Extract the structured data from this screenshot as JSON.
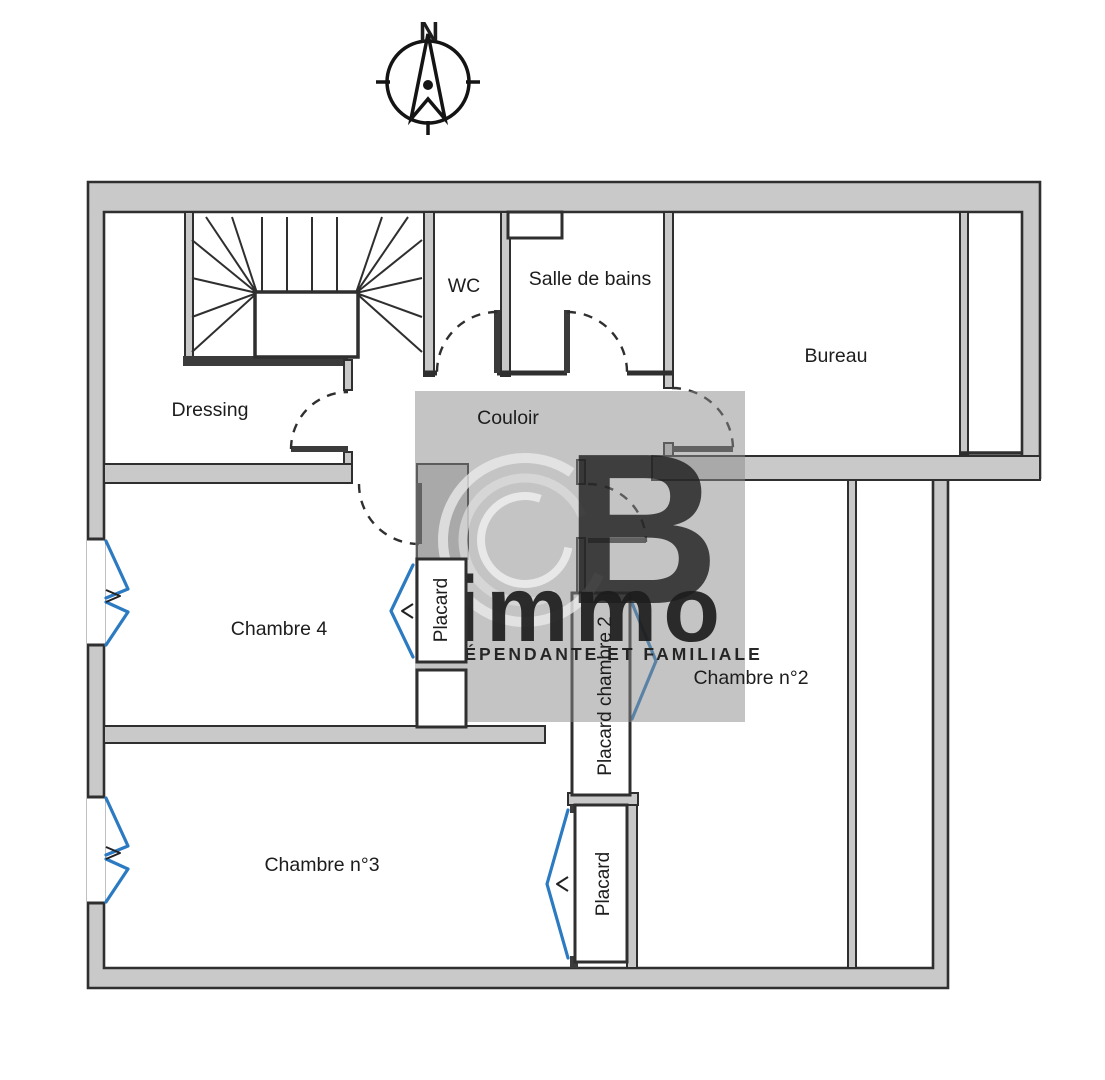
{
  "compass": {
    "north": "N"
  },
  "rooms": {
    "dressing": {
      "label": "Dressing"
    },
    "wc": {
      "label": "WC"
    },
    "salle_de_bains": {
      "label": "Salle de bains"
    },
    "bureau": {
      "label": "Bureau"
    },
    "couloir": {
      "label": "Couloir"
    },
    "chambre4": {
      "label": "Chambre 4"
    },
    "chambre2": {
      "label": "Chambre n°2"
    },
    "chambre3": {
      "label": "Chambre n°3"
    }
  },
  "closets": {
    "placard_chambre4": {
      "label": "Placard"
    },
    "placard_chambre2": {
      "label": "Placard chambre 2"
    },
    "placard_chambre3": {
      "label": "Placard"
    }
  },
  "watermark": {
    "letter_b": "B",
    "brand": "immo",
    "tagline": "INDÉPENDANTE ET FAMILIALE"
  },
  "colors": {
    "wall_fill": "#c9c9c9",
    "outline": "#2f2f2f",
    "window_blue": "#2b7ac2",
    "watermark_grey": "#8a8a8a",
    "logo_green": "#b7d884",
    "logo_green_light": "#e9f6d3",
    "logo_white": "#ffffff",
    "tagline_color": "#e9e7bd"
  }
}
